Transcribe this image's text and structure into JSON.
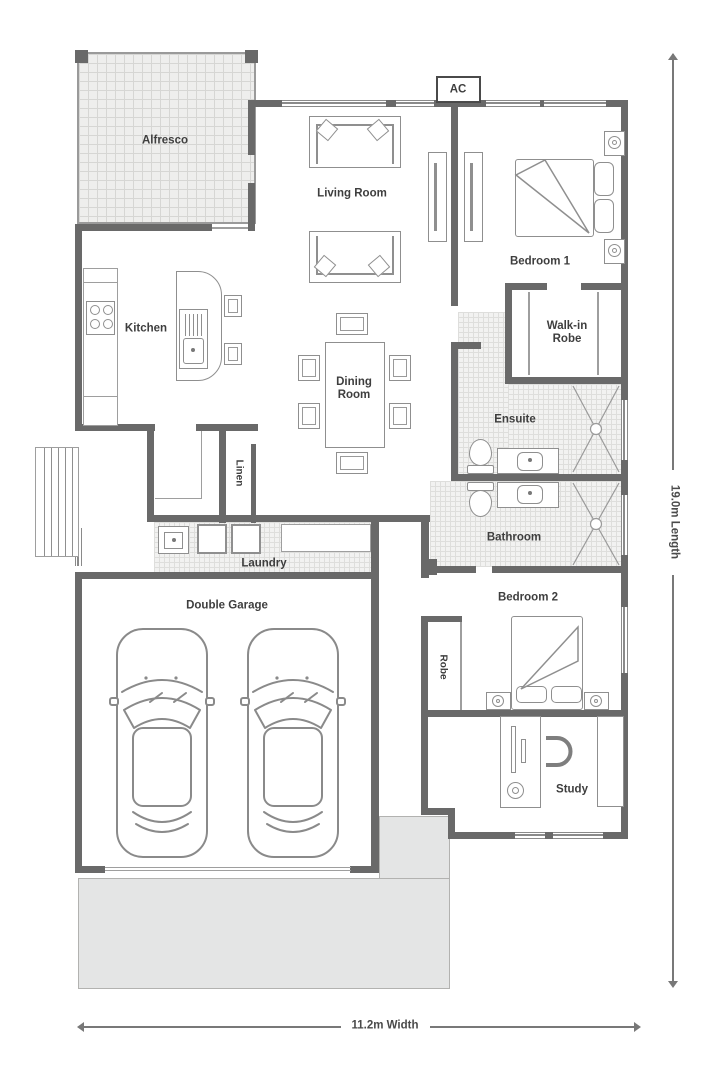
{
  "plan": {
    "ac_label": "AC",
    "rooms": {
      "alfresco": "Alfresco",
      "living": "Living Room",
      "kitchen": "Kitchen",
      "dining": "Dining Room",
      "bedroom1": "Bedroom 1",
      "wir": "Walk-in Robe",
      "ensuite": "Ensuite",
      "linen": "Linen",
      "bathroom": "Bathroom",
      "laundry": "Laundry",
      "garage": "Double Garage",
      "bedroom2": "Bedroom 2",
      "robe": "Robe",
      "study": "Study"
    },
    "dimensions": {
      "length": "19.0m Length",
      "width": "11.2m Width"
    },
    "colors": {
      "wall": "#696969",
      "tile_line": "#d6d6d4",
      "driveway": "#e4e5e5",
      "furniture_line": "#8f8f8f",
      "text": "#3e3e3e"
    }
  }
}
